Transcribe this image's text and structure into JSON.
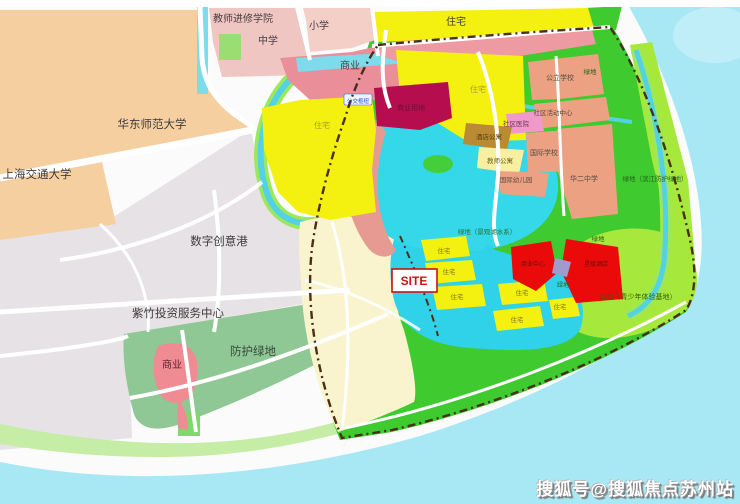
{
  "map": {
    "title": "规划示意图",
    "watermark": "搜狐号@搜狐焦点苏州站",
    "site_label": "SITE",
    "palette": {
      "sea": "#a8e8f5",
      "lake": "#35d8e8",
      "canal": "#52d2e4",
      "park_green": "#3fca2f",
      "light_green": "#a6e93c",
      "protect_green": "#8fc795",
      "river_strip_green": "#c6eda6",
      "residential_yellow": "#f4f010",
      "site_cream": "#f9f4cd",
      "campus_peach": "#f6cfa0",
      "city_gray": "#e6e2e5",
      "school_pink": "#efc6c2",
      "commercial_pink": "#ea8f9a",
      "education_salmon": "#eca183",
      "crimson": "#b60d4f",
      "red": "#ea0a0a",
      "brown": "#ba8b33",
      "magenta": "#f09aca",
      "violet": "#a09bcc",
      "road_white": "#ffffff",
      "boundary_dash": "#4a2f18",
      "site_text_red": "#cc1111"
    },
    "labels": [
      {
        "text": "教师进修学院",
        "x": 243,
        "y": 22,
        "size": 10,
        "color": "#474040",
        "bold": false
      },
      {
        "text": "中学",
        "x": 268,
        "y": 44,
        "size": 10,
        "color": "#474040",
        "bold": false
      },
      {
        "text": "小学",
        "x": 319,
        "y": 29,
        "size": 10,
        "color": "#474040",
        "bold": false
      },
      {
        "text": "商业",
        "x": 350,
        "y": 69,
        "size": 10,
        "color": "#4d3a3a",
        "bold": false
      },
      {
        "text": "住宅",
        "x": 456,
        "y": 25,
        "size": 10,
        "color": "#474040",
        "bold": false
      },
      {
        "text": "华东师范大学",
        "x": 152,
        "y": 128,
        "size": 11.5,
        "color": "#3f3b3b",
        "bold": false
      },
      {
        "text": "上海交通大学",
        "x": 37,
        "y": 178,
        "size": 11.5,
        "color": "#3f3b3b",
        "bold": false
      },
      {
        "text": "数字创意港",
        "x": 219,
        "y": 245,
        "size": 11.5,
        "color": "#3f3b3b",
        "bold": false
      },
      {
        "text": "紫竹投资服务中心",
        "x": 178,
        "y": 317,
        "size": 11.5,
        "color": "#3f3b3b",
        "bold": false
      },
      {
        "text": "防护绿地",
        "x": 253,
        "y": 355,
        "size": 11.5,
        "color": "#39493b",
        "bold": false
      },
      {
        "text": "商业",
        "x": 172,
        "y": 368,
        "size": 10,
        "color": "#58262b",
        "bold": false
      },
      {
        "text": "住宅",
        "x": 322,
        "y": 128,
        "size": 8,
        "color": "#a8a037",
        "bold": false
      },
      {
        "text": "住宅",
        "x": 478,
        "y": 92,
        "size": 8,
        "color": "#a8a037",
        "bold": false
      },
      {
        "text": "商业用地",
        "x": 411,
        "y": 110,
        "size": 7,
        "color": "#700e36",
        "bold": false
      },
      {
        "text": "公交枢纽",
        "x": 358,
        "y": 103,
        "size": 5.5,
        "color": "#2255cc",
        "bold": false
      },
      {
        "text": "公立学校",
        "x": 560,
        "y": 80,
        "size": 7,
        "color": "#5a4a40",
        "bold": false
      },
      {
        "text": "绿地",
        "x": 590,
        "y": 74,
        "size": 6.5,
        "color": "#266418",
        "bold": false
      },
      {
        "text": "社区活动中心",
        "x": 553,
        "y": 115,
        "size": 6.5,
        "color": "#5a4a40",
        "bold": false
      },
      {
        "text": "社区医院",
        "x": 516,
        "y": 126,
        "size": 6.5,
        "color": "#6d3257",
        "bold": false
      },
      {
        "text": "酒店公寓",
        "x": 489,
        "y": 139,
        "size": 6.5,
        "color": "#54400a",
        "bold": false
      },
      {
        "text": "教师公寓",
        "x": 500,
        "y": 163,
        "size": 6.5,
        "color": "#6a6020",
        "bold": false
      },
      {
        "text": "国际学校",
        "x": 544,
        "y": 155,
        "size": 7,
        "color": "#5a4a40",
        "bold": false
      },
      {
        "text": "国际幼儿园",
        "x": 516,
        "y": 182,
        "size": 6.5,
        "color": "#5a4a40",
        "bold": false
      },
      {
        "text": "华二中学",
        "x": 584,
        "y": 181,
        "size": 7,
        "color": "#5a4a40",
        "bold": false
      },
      {
        "text": "绿地（滨江防护绿地）",
        "x": 655,
        "y": 181,
        "size": 6.5,
        "color": "#266418",
        "bold": false
      },
      {
        "text": "绿地（景观湖水系）",
        "x": 487,
        "y": 234,
        "size": 6.5,
        "color": "#24713a",
        "bold": false
      },
      {
        "text": "住宅",
        "x": 444,
        "y": 253,
        "size": 6.5,
        "color": "#857a19",
        "bold": false
      },
      {
        "text": "住宅",
        "x": 449,
        "y": 274,
        "size": 6.5,
        "color": "#857a19",
        "bold": false
      },
      {
        "text": "住宅",
        "x": 457,
        "y": 299,
        "size": 6.5,
        "color": "#857a19",
        "bold": false
      },
      {
        "text": "住宅",
        "x": 517,
        "y": 322,
        "size": 6.5,
        "color": "#857a19",
        "bold": false
      },
      {
        "text": "住宅",
        "x": 522,
        "y": 295,
        "size": 6.5,
        "color": "#857a19",
        "bold": false
      },
      {
        "text": "住宅",
        "x": 560,
        "y": 309,
        "size": 6.5,
        "color": "#857a19",
        "bold": false
      },
      {
        "text": "绿地",
        "x": 563,
        "y": 287,
        "size": 6,
        "color": "#266418",
        "bold": false
      },
      {
        "text": "绿地",
        "x": 598,
        "y": 241,
        "size": 6.5,
        "color": "#266418",
        "bold": false
      },
      {
        "text": "商业中心",
        "x": 533,
        "y": 266,
        "size": 6,
        "color": "#6e0d0d",
        "bold": false
      },
      {
        "text": "星级酒店",
        "x": 596,
        "y": 266,
        "size": 6,
        "color": "#6e0d0d",
        "bold": false
      },
      {
        "text": "绿地（青少年体验基地）",
        "x": 638,
        "y": 299,
        "size": 7,
        "color": "#356008",
        "bold": false
      }
    ]
  }
}
